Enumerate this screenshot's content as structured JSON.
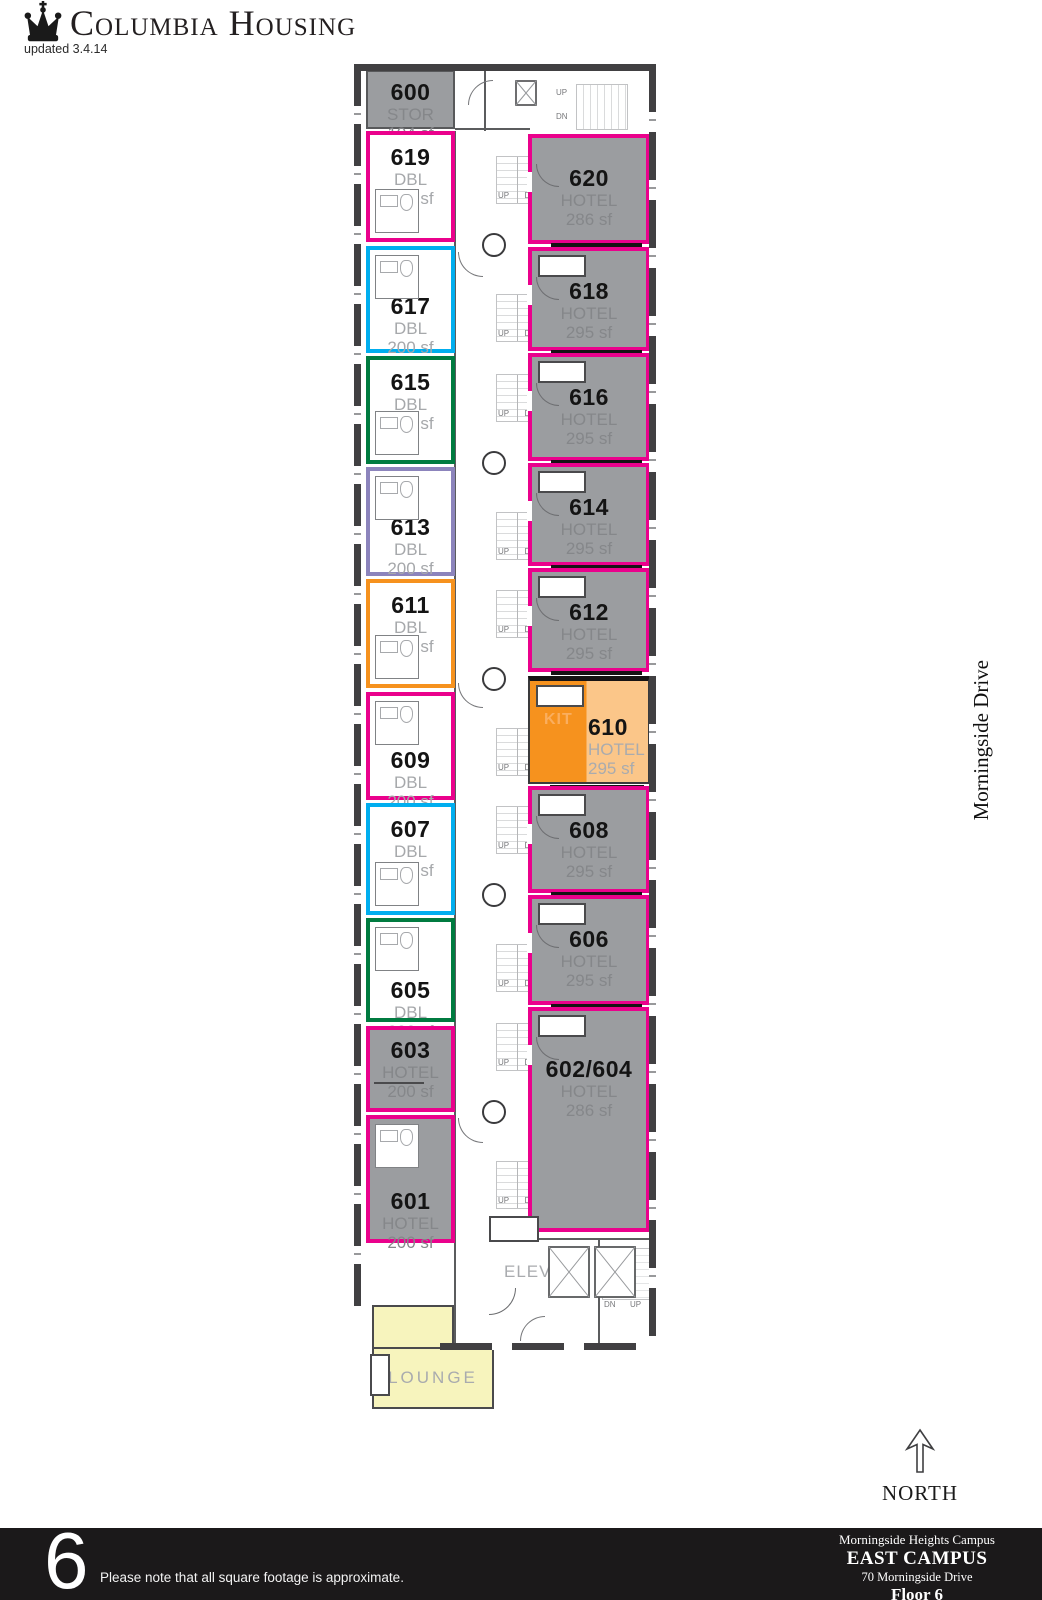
{
  "header": {
    "brand": "Columbia Housing",
    "updated": "updated 3.4.14"
  },
  "plan": {
    "street_label": "Morningside Drive",
    "labels": {
      "up": "UP",
      "dn": "DN",
      "elev": "ELEV",
      "kit": "KIT",
      "lounge": "LOUNGE"
    },
    "left_rooms": [
      {
        "number": "600",
        "type": "STOR",
        "sf": "104 sf"
      },
      {
        "number": "619",
        "type": "DBL",
        "sf": "200 sf"
      },
      {
        "number": "617",
        "type": "DBL",
        "sf": "200 sf"
      },
      {
        "number": "615",
        "type": "DBL",
        "sf": "200 sf"
      },
      {
        "number": "613",
        "type": "DBL",
        "sf": "200 sf"
      },
      {
        "number": "611",
        "type": "DBL",
        "sf": "200 sf"
      },
      {
        "number": "609",
        "type": "DBL",
        "sf": "200 sf"
      },
      {
        "number": "607",
        "type": "DBL",
        "sf": "200 sf"
      },
      {
        "number": "605",
        "type": "DBL",
        "sf": "200 sf"
      },
      {
        "number": "603",
        "type": "HOTEL",
        "sf": "200 sf"
      },
      {
        "number": "601",
        "type": "HOTEL",
        "sf": "200 sf"
      }
    ],
    "right_rooms": [
      {
        "number": "620",
        "type": "HOTEL",
        "sf": "286 sf"
      },
      {
        "number": "618",
        "type": "HOTEL",
        "sf": "295 sf"
      },
      {
        "number": "616",
        "type": "HOTEL",
        "sf": "295 sf"
      },
      {
        "number": "614",
        "type": "HOTEL",
        "sf": "295 sf"
      },
      {
        "number": "612",
        "type": "HOTEL",
        "sf": "295 sf"
      },
      {
        "number": "610",
        "type": "HOTEL",
        "sf": "295 sf"
      },
      {
        "number": "608",
        "type": "HOTEL",
        "sf": "295 sf"
      },
      {
        "number": "606",
        "type": "HOTEL",
        "sf": "295 sf"
      },
      {
        "number": "602/604",
        "type": "HOTEL",
        "sf": "286 sf"
      }
    ],
    "colors": {
      "magenta": "#ea018c",
      "cyan": "#00aeef",
      "green": "#007b40",
      "purple": "#8c84bc",
      "orange": "#f6921e",
      "light_orange": "#fbc689",
      "room_gray": "#9b9da0",
      "wall": "#414042",
      "lounge_yellow": "#f7f4bd"
    }
  },
  "compass": {
    "label": "NORTH"
  },
  "footer": {
    "floor_number": "6",
    "note": "Please note that all square footage is approximate.",
    "campus": "Morningside Heights Campus",
    "building": "EAST CAMPUS",
    "address": "70 Morningside Drive",
    "floor": "Floor 6"
  }
}
